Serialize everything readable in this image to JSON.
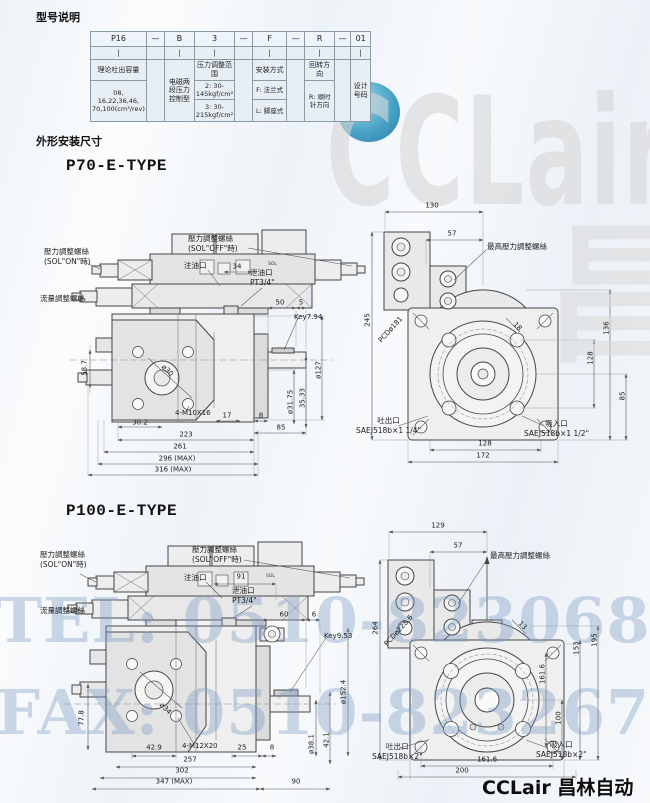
{
  "page": {
    "section1_title": "型号说明",
    "section2_title": "外形安装尺寸",
    "p70_title": "P70-E-TYPE",
    "p100_title": "P100-E-TYPE",
    "footer_logo": "CCLair 昌林自动化"
  },
  "watermark": {
    "logo_text": "CCLair",
    "logo_cn": "昌林自动化",
    "tel": "TEL: 0510-82306871",
    "fax": "FAX: 0510-82326771",
    "circle_color": "#2d93bd",
    "phone_color": "#7d9cc4",
    "gray": "#d7d7d7"
  },
  "model_table": {
    "codes": [
      "P16",
      "—",
      "B",
      "3",
      "—",
      "F",
      "—",
      "R",
      "—",
      "01"
    ],
    "bar": "|",
    "col_p16": {
      "header": "理论吐出容量",
      "values": "08, 16,22,36,46, 70,100(cm³/rev)"
    },
    "col_b": {
      "text": "电磁两段压力控制型"
    },
    "col_3": {
      "header": "压力调整范围",
      "v1": "2: 30-145kgf/cm²",
      "v2": "3: 30-215kgf/cm²"
    },
    "col_f": {
      "header": "安装方式",
      "v1": "F: 法兰式",
      "v2": "L: 脚座式"
    },
    "col_r": {
      "header": "回转方向",
      "v1": "R: 顺时针方向"
    },
    "col_01": {
      "text": "设计号码"
    }
  },
  "p70_side": {
    "sol_on": "壓力調整螺絲\n(SOL\"ON\"時)",
    "sol_off": "壓力調整螺絲\n(SOL\"OFF\"時)",
    "oil_fill": "注油口",
    "drain": "泄油口\nPT3/4\"",
    "flow_screw": "流量調整螺絲",
    "sol_marking": "SOL",
    "dim_34": "34",
    "dim_50": "50",
    "dim_5": "5",
    "key": "Key7.94",
    "dim_58_7": "58.7",
    "dia_30": "ø30",
    "bolt": "4-M10X16",
    "dim_30_2": "30.2",
    "dim_17": "17",
    "dim_8": "8",
    "dim_85": "85",
    "dim_223": "223",
    "dim_261": "261",
    "dim_296": "296 (MAX)",
    "dim_316": "316 (MAX)",
    "dia_31_75": "ø31.75",
    "dim_35_33": "35.33",
    "dia_127": "ø127"
  },
  "p70_rear": {
    "max_pressure_screw": "最高壓力調整螺絲",
    "dim_130": "130",
    "dim_57": "57",
    "dim_245": "245",
    "pcd": "PCDø181",
    "dim_136": "136",
    "dim_128_v": "128",
    "dim_85": "85",
    "dim_18": "18",
    "dim_128": "128",
    "dim_172": "172",
    "outlet": "吐出口\nSAEJ518b×1 1/4\"",
    "inlet": "吸入口\nSAEJ518b×1 1/2\""
  },
  "p100_side": {
    "sol_on": "壓力調整螺絲\n(SOL\"ON\"時)",
    "sol_off": "壓力調整螺絲\n(SOL\"OFF\"時)",
    "oil_fill": "注油口",
    "drain": "泄油口\nPT3/4\"",
    "flow_screw": "流量調整螺絲",
    "sol_marking": "SOL",
    "dim_91": "91",
    "dim_60": "60",
    "dim_6": "6",
    "key": "Key9.53",
    "dia_152_4": "ø152.4",
    "dim_77_8": "77.8",
    "dia_34": "ø34",
    "dim_42_9": "42.9",
    "bolt": "4-M12X20",
    "dim_25": "25",
    "dim_8": "8",
    "dim_257": "257",
    "dim_302": "302",
    "dim_347": "347 (MAX)",
    "dim_90": "90",
    "dia_38_1": "ø38.1",
    "dim_42_1": "42.1"
  },
  "p100_rear": {
    "max_pressure_screw": "最高壓力調整螺絲",
    "dim_129": "129",
    "dim_57": "57",
    "dim_264": "264",
    "pcd": "PCDø228.6",
    "dim_195": "195",
    "dim_153": "153",
    "dim_161_6_v": "161.6",
    "dim_100": "100",
    "dim_13": "13",
    "dim_161_6": "161.6",
    "dim_200": "200",
    "outlet": "吐出口\nSAEJ518b×2\"",
    "inlet": "吸入口\nSAEJ518b×2\""
  }
}
